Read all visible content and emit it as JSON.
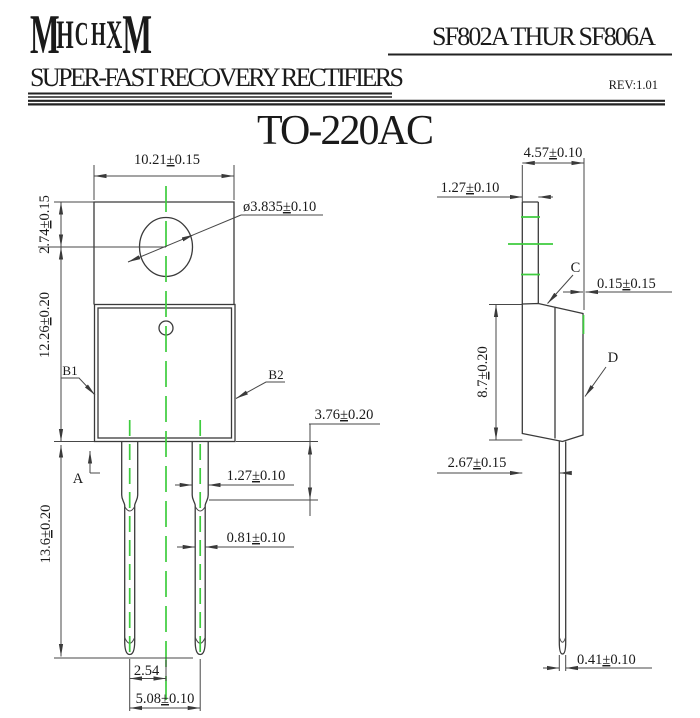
{
  "header": {
    "logo_letters": [
      "M",
      "H",
      "C",
      "H",
      "X",
      "M"
    ],
    "part_range": "SF802A THUR SF806A",
    "subtitle": "SUPER-FAST RECOVERY RECTIFIERS",
    "revision": "REV:1.01"
  },
  "package": {
    "title": "TO-220AC"
  },
  "front_view": {
    "tab_width": "10.21±0.15",
    "hole_diameter": "ø3.835±0.10",
    "tab_top_to_hole_center": "2.74±0.15",
    "hole_center_to_body_bottom": "12.26±0.20",
    "lead_length": "13.6±0.20",
    "shoulder_height": "3.76±0.20",
    "lead_width_upper": "1.27±0.10",
    "lead_width_lower": "0.81±0.10",
    "lead_center_offset": "2.54",
    "lead_pitch": "5.08±0.10",
    "datum_a": "A",
    "label_b1": "B1",
    "label_b2": "B2"
  },
  "side_view": {
    "overall_depth": "4.57±0.10",
    "tab_thickness": "1.27±0.10",
    "edge_step": "0.15±0.15",
    "body_depth": "8.7±0.20",
    "lead_setback": "2.67±0.15",
    "lead_thickness": "0.41±0.10",
    "label_c": "C",
    "label_d": "D"
  },
  "colors": {
    "centerline_green": "#3ecc3e",
    "drawing_line": "#3a3a3a",
    "text": "#1a1a1a"
  }
}
